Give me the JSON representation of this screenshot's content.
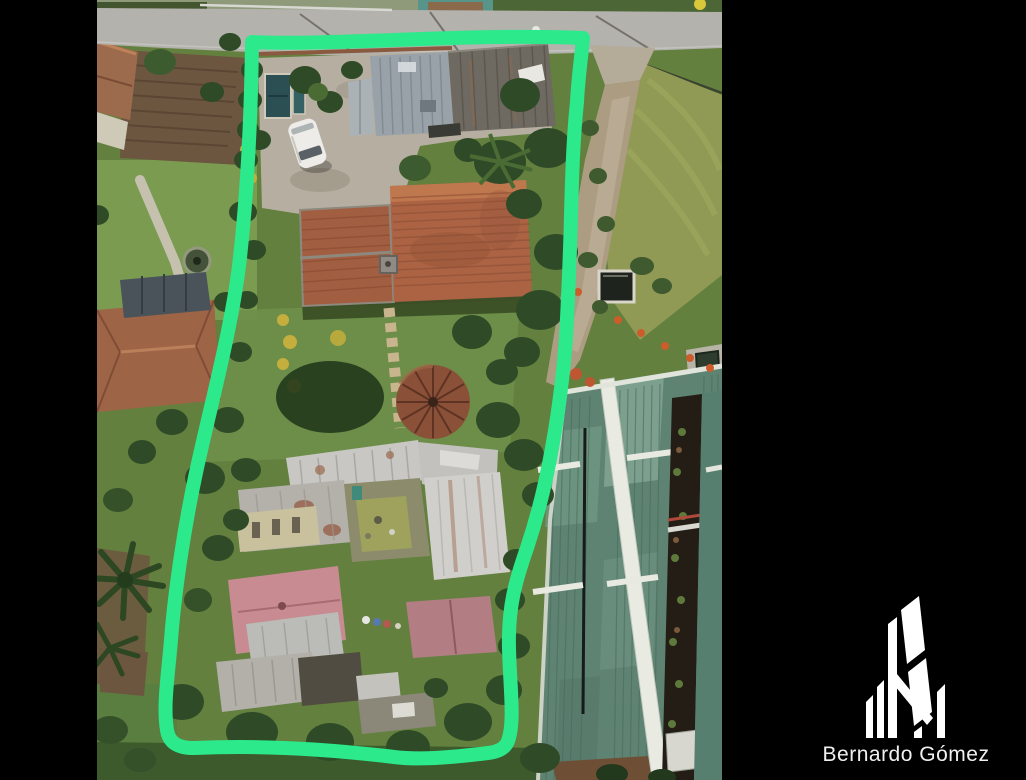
{
  "photo": {
    "kind": "aerial-drone-photograph",
    "subject": "Long residential lot outlined in green, with tile-roof house, metal sheds, gardens and a large green warehouse roof beside it",
    "frame_background": "#000000"
  },
  "overlay": {
    "parcel_outline_color": "#2ce98b"
  },
  "branding": {
    "name": "Bernardo Gómez",
    "logo": "building-logo",
    "logo_color": "#ffffff",
    "text_color": "#f0f0f0"
  }
}
